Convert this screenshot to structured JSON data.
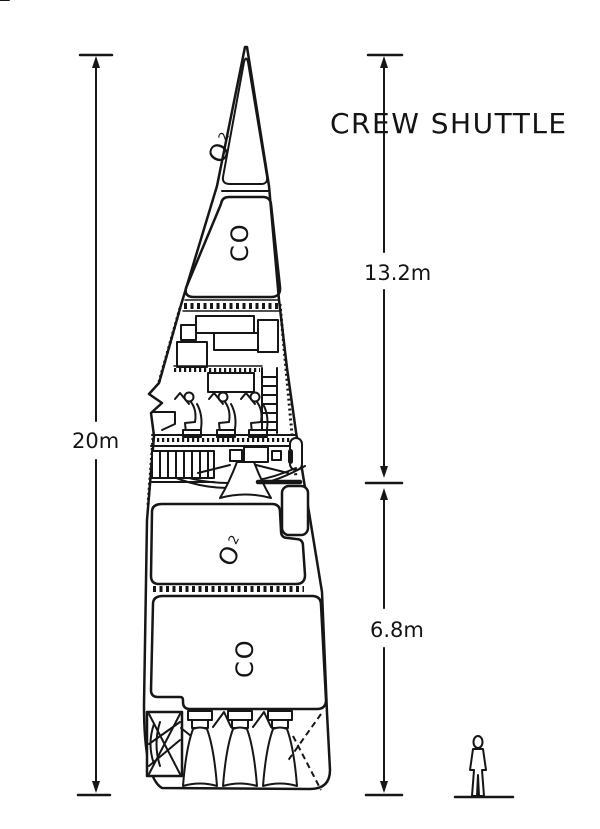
{
  "title": "CREW SHUTTLE",
  "dimensions": {
    "total": "20m",
    "upper": "13.2m",
    "lower": "6.8m"
  },
  "tanks": {
    "nose_oxygen": {
      "main": "O",
      "sub": "2"
    },
    "upper_fuel": {
      "main": "CO"
    },
    "mid_oxygen": {
      "main": "O",
      "sub": "2"
    },
    "aft_fuel": {
      "main": "CO"
    }
  },
  "icons": {
    "scale_figure": "standing-human-silhouette"
  },
  "colors": {
    "ink": "#161616",
    "paper": "#ffffff"
  }
}
